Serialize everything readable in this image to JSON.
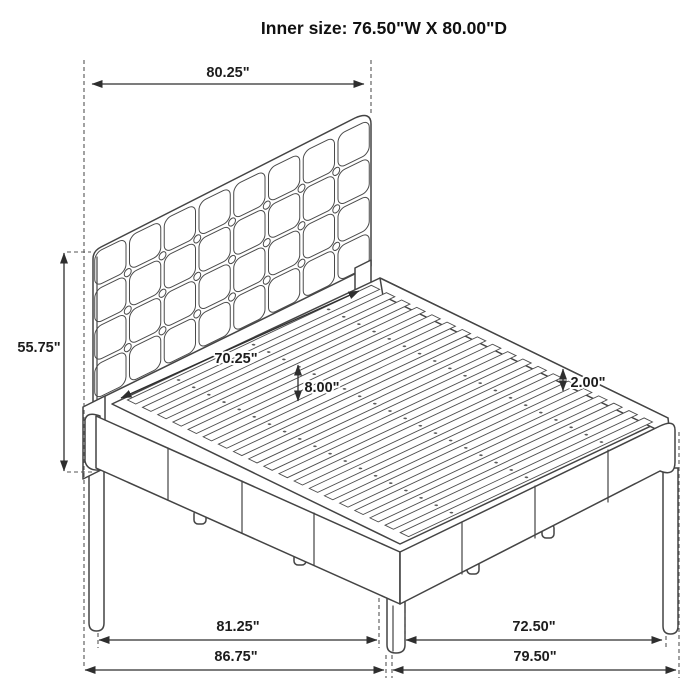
{
  "title": "Inner size: 76.50\"W X 80.00\"D",
  "inner_size": {
    "width": "76.50\"",
    "depth": "80.00\""
  },
  "dimensions": {
    "top_width": "80.25\"",
    "headboard_height": "55.75\"",
    "inner_width": "70.25\"",
    "slat_clearance": "8.00\"",
    "rail_lip": "2.00\"",
    "bottom_left_inner": "81.25\"",
    "bottom_left_outer": "86.75\"",
    "bottom_right_inner": "72.50\"",
    "bottom_right_outer": "79.50\""
  },
  "colors": {
    "line": "#444444",
    "dash": "#555555",
    "text": "#1d1d1d",
    "background": "#ffffff"
  }
}
